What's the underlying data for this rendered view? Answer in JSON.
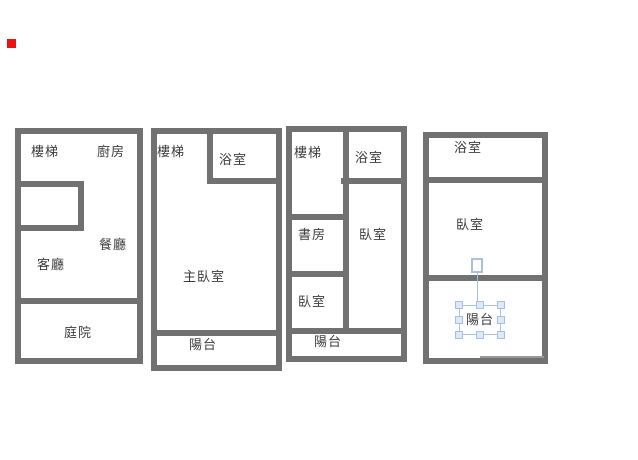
{
  "app": {
    "description_note": "drawing canvas with four floor plans",
    "colors": {
      "wall": "#717171",
      "text": "#3d3d3d",
      "selection_blue": "#a9c0e0",
      "selection_handle_fill": "#dfe9f6",
      "marker_red": "#ee1111",
      "thin_line": "#9a9a9a",
      "background": "#ffffff"
    }
  },
  "plans": [
    {
      "id": "floor-1",
      "rooms": {
        "stairs": "樓梯",
        "kitchen": "廚房",
        "dining": "餐廳",
        "living": "客廳",
        "courtyard": "庭院"
      }
    },
    {
      "id": "floor-2",
      "rooms": {
        "stairs": "樓梯",
        "bath": "浴室",
        "master_bedroom": "主臥室",
        "balcony": "陽台"
      }
    },
    {
      "id": "floor-3",
      "rooms": {
        "stairs": "樓梯",
        "bath": "浴室",
        "study": "書房",
        "bedroom_right": "臥室",
        "bedroom_left": "臥室",
        "balcony": "陽台"
      }
    },
    {
      "id": "floor-4",
      "rooms": {
        "bath": "浴室",
        "bedroom": "臥室",
        "balcony": "陽台"
      }
    }
  ],
  "selection": {
    "selected_label": "陽台",
    "selected_plan": "floor-4",
    "handles": 8,
    "has_rotation_handle": true
  }
}
